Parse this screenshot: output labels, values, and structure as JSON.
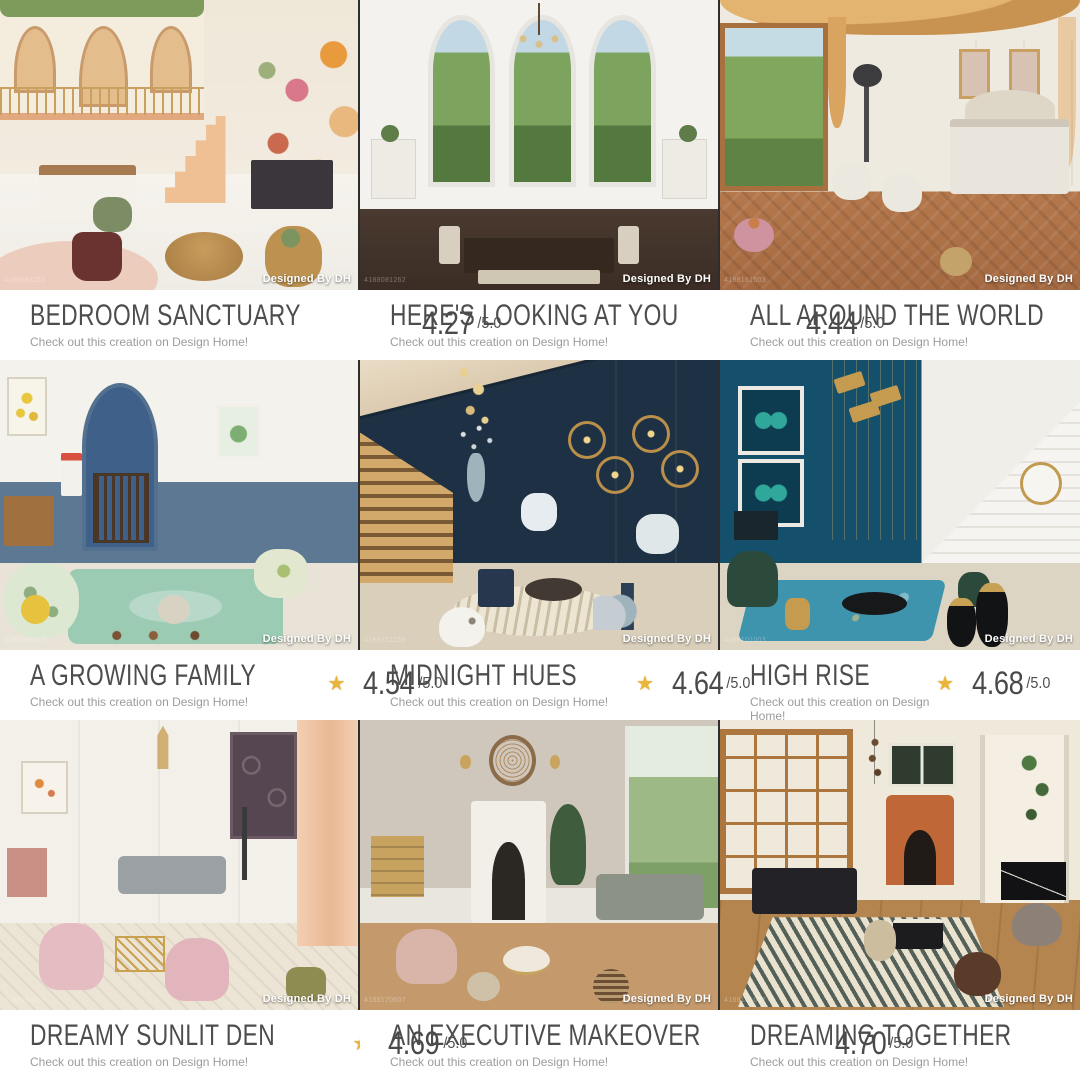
{
  "app": {
    "star_glyph": "★",
    "star_color": "#e9b53a",
    "title_color": "#4d4d4d",
    "subtitle_color": "#9c9c9c"
  },
  "cards": [
    {
      "title": "BEDROOM SANCTUARY",
      "rating": "4.27",
      "rating_max": "/5.0",
      "subtitle": "Check out this creation on Design Home!",
      "overlay": "Designed By DH",
      "photo_id": "4188081151",
      "scene": "cream bedroom with mezzanine arches, vine garland, floral mural, black dresser"
    },
    {
      "title": "HERE'S LOOKING AT YOU",
      "rating": "4.44",
      "rating_max": "/5.0",
      "subtitle": "Check out this creation on Design Home!",
      "overlay": "Designed By DH",
      "photo_id": "4188081262",
      "scene": "white dining room with three arched garden windows and dark wood table"
    },
    {
      "title": "ALL AROUND THE WORLD",
      "rating": "4.50",
      "rating_max": "/5.0",
      "subtitle": "Check out this creation on Design Home!",
      "overlay": "Designed By DH",
      "photo_id": "4188161503",
      "scene": "gold-draped bedroom with garden window, white bed and herringbone floor"
    },
    {
      "title": "A GROWING FAMILY",
      "rating": "4.54",
      "rating_max": "/5.0",
      "subtitle": "Check out this creation on Design Home!",
      "overlay": "Designed By DH",
      "photo_id": "4188085163",
      "scene": "nursery with blue arched alcove, crib, mint rug and floral armchair"
    },
    {
      "title": "MIDNIGHT HUES",
      "rating": "4.64",
      "rating_max": "/5.0",
      "subtitle": "Check out this creation on Design Home!",
      "overlay": "Designed By DH",
      "photo_id": "4188151159",
      "scene": "navy entry hall with lit wooden stairs, gold candle rings and white dog"
    },
    {
      "title": "HIGH RISE",
      "rating": "4.68",
      "rating_max": "/5.0",
      "subtitle": "Check out this creation on Design Home!",
      "overlay": "Designed By DH",
      "photo_id": "4188101003",
      "scene": "teal-blue wall with butterfly art, white staircase, teal rug, green chairs"
    },
    {
      "title": "DREAMY SUNLIT DEN",
      "rating": "4.69",
      "rating_max": "/5.0",
      "subtitle": "Check out this creation on Design Home!",
      "overlay": "Designed By DH",
      "photo_id": "4188966158",
      "scene": "ornate white salon with peach drapes, pink chairs, gray sofa, gold table"
    },
    {
      "title": "AN EXECUTIVE MAKEOVER",
      "rating": "4.70",
      "rating_max": "/5.0",
      "subtitle": "Check out this creation on Design Home!",
      "overlay": "Designed By DH",
      "photo_id": "4188170607",
      "scene": "greige lounge with white fireplace, wicker clock, sage sofas, garden windows"
    },
    {
      "title": "DREAMING TOGETHER",
      "rating": "4.70",
      "rating_max": "/5.0",
      "subtitle": "Check out this creation on Design Home!",
      "overlay": "Designed By DH",
      "photo_id": "4188101002",
      "scene": "wood-framed windows, carved orange fireplace, black sofa and zebra rug"
    }
  ]
}
